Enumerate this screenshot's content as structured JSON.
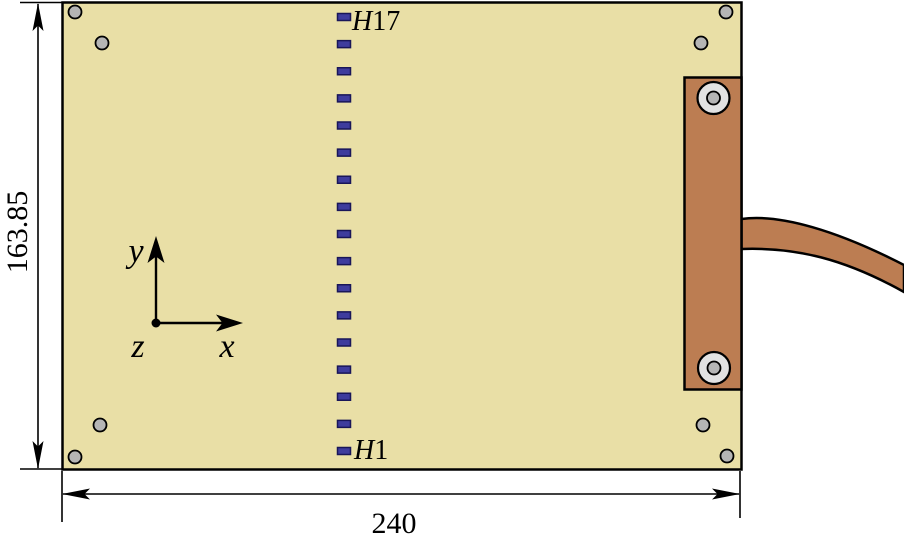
{
  "drawing": {
    "board": {
      "width_label": "240",
      "height_label": "163.85"
    },
    "axes": {
      "x": "x",
      "y": "y",
      "z": "z"
    },
    "holes": {
      "count": 17,
      "top_label": {
        "prefix": "H",
        "number": "17"
      },
      "bottom_label": {
        "prefix": "H",
        "number": "1"
      }
    }
  },
  "colors": {
    "background": "#ffffff",
    "board_fill": "#e9dfa6",
    "copper_fill": "#bc7d52",
    "hole_fill": "#3e3c9d",
    "hole_border": "#191659",
    "screw_fill": "#b5b5b5",
    "ring_fill": "#e2e2e2",
    "outline": "#000000"
  },
  "geometry": {
    "hole_column": {
      "x": 337.5,
      "w": 13,
      "h": 7,
      "first_cy": 17,
      "last_cy": 451
    },
    "corner_screws": {
      "r": 6.5,
      "centers": [
        [
          75,
          12
        ],
        [
          102,
          43
        ],
        [
          726,
          12
        ],
        [
          701,
          43
        ],
        [
          75,
          457
        ],
        [
          100,
          425
        ],
        [
          727,
          456
        ],
        [
          703,
          425
        ]
      ]
    },
    "strip_screws": {
      "outer_r": 16,
      "inner_r": 6.5,
      "centers": [
        [
          713.5,
          98
        ],
        [
          714,
          368
        ]
      ]
    }
  }
}
